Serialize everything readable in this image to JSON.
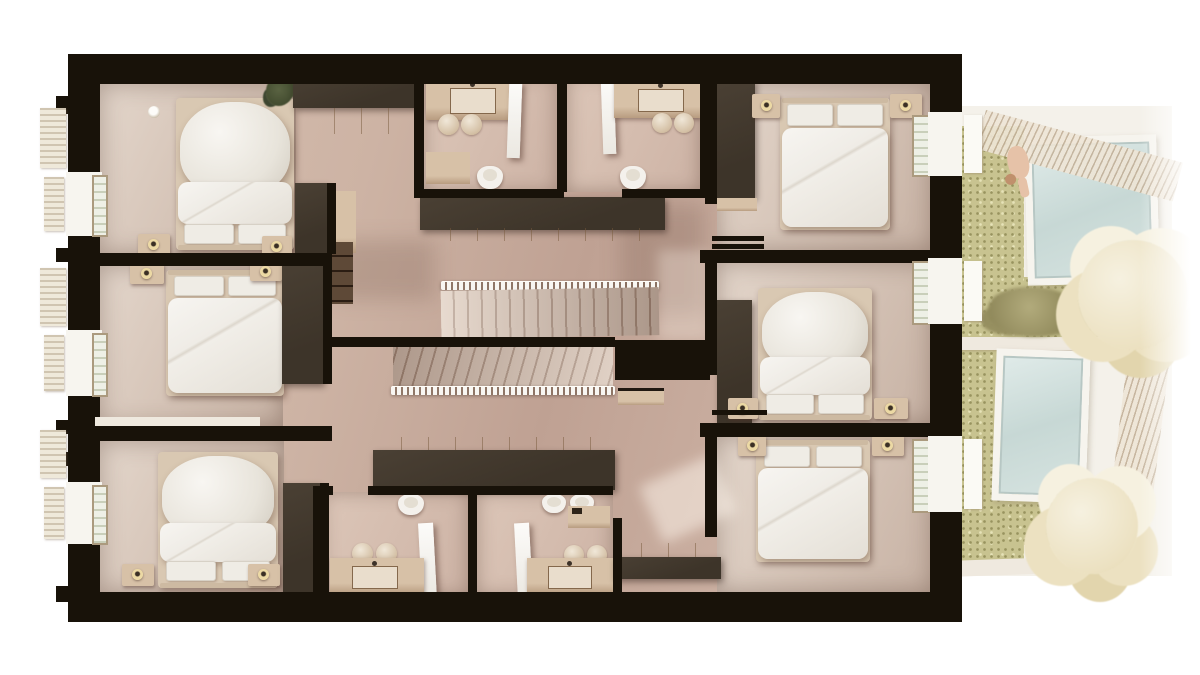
{
  "scene": {
    "type": "architectural-floor-plan-render",
    "view": "top-down-3d-section",
    "rooms": [
      {
        "id": "bedroom-top-left",
        "furniture": [
          "double-bed",
          "duvet",
          "pillows",
          "nightstands",
          "table-lamps",
          "dark-wardrobe",
          "wood-dresser",
          "plant",
          "ceiling-lamp",
          "window"
        ]
      },
      {
        "id": "bedroom-mid-left",
        "furniture": [
          "double-bed",
          "duvet",
          "pillows",
          "nightstands",
          "table-lamps",
          "dark-wardrobe",
          "window"
        ]
      },
      {
        "id": "bedroom-bottom-left",
        "furniture": [
          "double-bed",
          "duvet",
          "pillows",
          "nightstands",
          "table-lamps",
          "dark-wardrobe",
          "window"
        ]
      },
      {
        "id": "bedroom-top-right",
        "furniture": [
          "double-bed",
          "duvet",
          "pillows",
          "nightstands",
          "table-lamps",
          "dark-wardrobe",
          "shelf",
          "window"
        ]
      },
      {
        "id": "bedroom-mid-right",
        "furniture": [
          "double-bed",
          "duvet",
          "pillows",
          "nightstands",
          "table-lamps",
          "dark-wardrobe",
          "window"
        ]
      },
      {
        "id": "bedroom-bottom-right",
        "furniture": [
          "double-bed",
          "duvet",
          "pillows",
          "nightstands",
          "table-lamps",
          "window"
        ]
      },
      {
        "id": "bathroom-top-left",
        "furniture": [
          "vanity-sink",
          "towels",
          "toilet",
          "shower-screen",
          "bench"
        ]
      },
      {
        "id": "bathroom-top-right",
        "furniture": [
          "vanity-sink",
          "towels",
          "toilet",
          "shower-screen",
          "wall-hooks"
        ]
      },
      {
        "id": "bathroom-bottom-left",
        "furniture": [
          "vanity-sink",
          "towels",
          "toilet",
          "shower-screen"
        ]
      },
      {
        "id": "bathroom-bottom-right",
        "furniture": [
          "vanity-sink",
          "towels",
          "two-toilets",
          "shower-tray",
          "shower-screen"
        ]
      },
      {
        "id": "hallway-landing",
        "furniture": [
          "built-in-wardrobe-top",
          "built-in-wardrobe-mid",
          "built-in-wardrobe-bottom",
          "shelf-cabinet",
          "console-shelf"
        ]
      },
      {
        "id": "staircase",
        "parts": [
          "upper-flight",
          "lower-flight",
          "upper-railing",
          "lower-railing",
          "mid-wall"
        ]
      }
    ],
    "outdoor": {
      "id": "courtyard",
      "elements": [
        "lawn",
        "upper-skylight",
        "lower-skylight",
        "shrub",
        "large-tree",
        "small-tree",
        "sitting-person",
        "hatched-boundary-wall",
        "white-patio-walls"
      ]
    }
  },
  "colors": {
    "wall": "#181209",
    "wardrobe": "#3d3429",
    "wardrobe-hi": "#4a4034",
    "wood": "#d7c1a7",
    "wood-dark": "#b89c80",
    "bedframe": "#d9c8b2",
    "pillow": "#efece5",
    "lamp": "#ecd9a4",
    "win-frame": "#ab9a7e",
    "glass-1": "#eef0e6",
    "glass-2": "#c9cfba",
    "grass": "#c8c390",
    "grass-dot-dark": "#98935f",
    "grass-dot-light": "#e6e2b8",
    "sky-1": "#e0ebe9",
    "sky-2": "#c7d8d5",
    "sky-frame": "#f6f4ee",
    "patio": "#f4f1ea",
    "tree-1": "#f6f1e0",
    "tree-2": "#ece1c1",
    "tree-3": "#e2d5ad",
    "hatch-bg": "#eee5d6",
    "hatch-line": "#c2b098",
    "skin": "#e6c2a8"
  }
}
